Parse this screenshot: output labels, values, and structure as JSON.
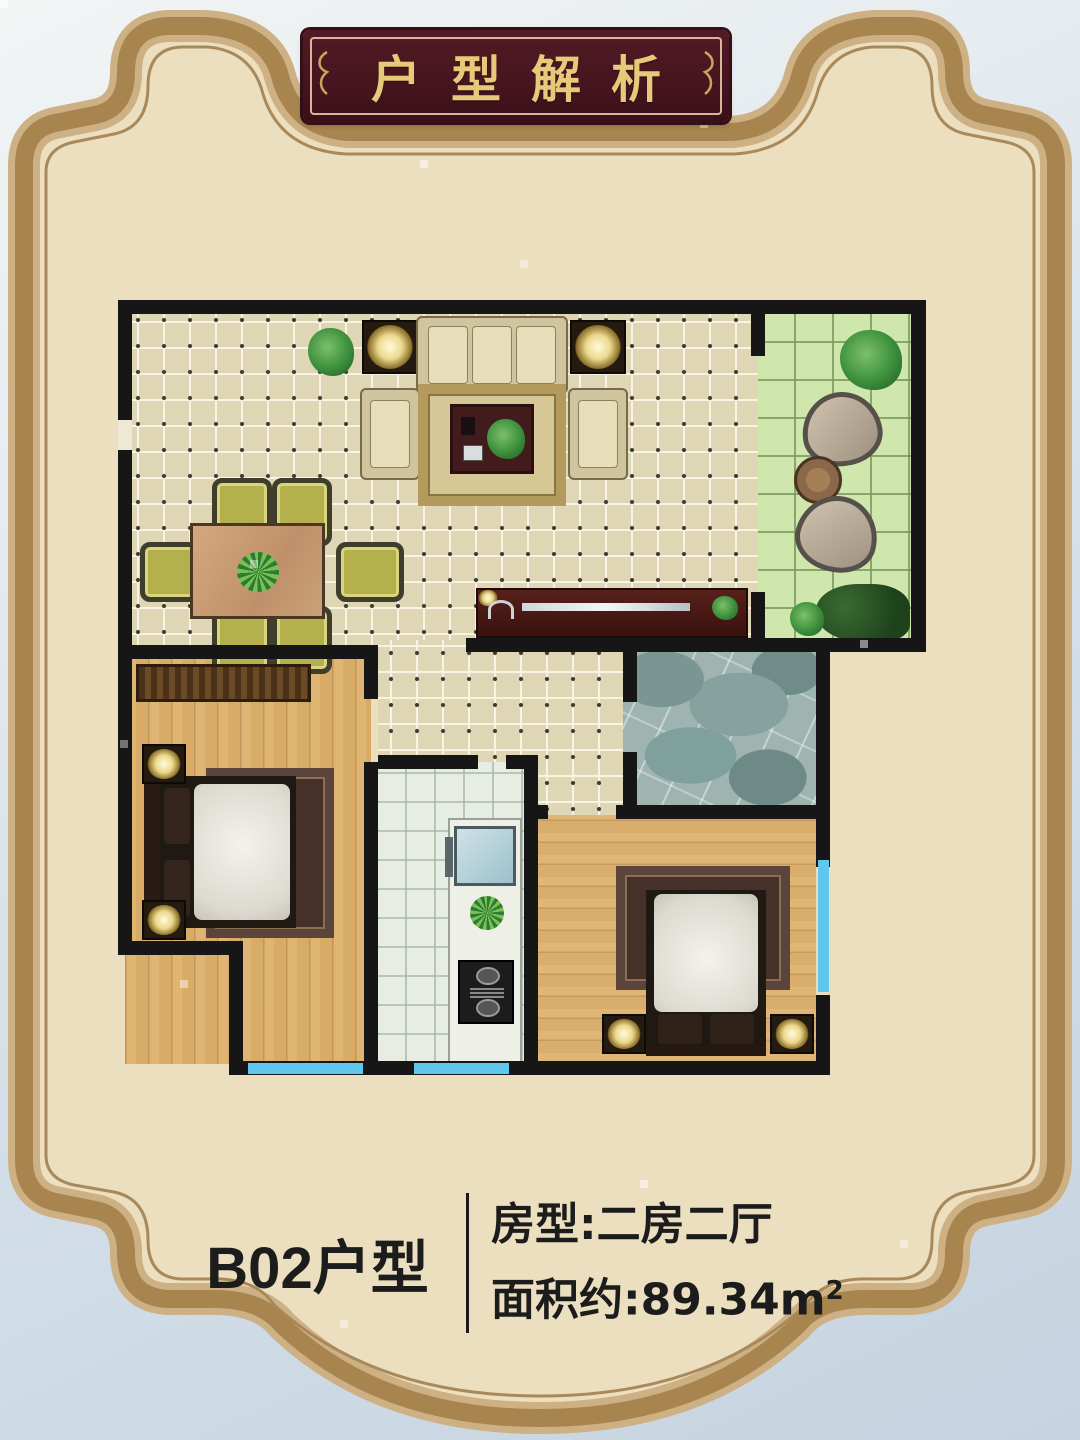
{
  "poster": {
    "title": "户型解析",
    "unit": {
      "label": "B02户型"
    },
    "specs": {
      "room_type": "房型:二房二厅",
      "area_label": "面积约:89.34m",
      "area_sup": "2"
    },
    "colors": {
      "poster_cream": "#ecdfc0",
      "frame_band_dark": "#a8854e",
      "frame_band_light": "#cdb184",
      "frame_thin_line": "#a9895a",
      "plaque_maroon": "#47151f",
      "title_gold": "#e6c979",
      "wall_black": "#161616",
      "window_blue": "#5fc6ee",
      "photo_background": "#d4dfe8"
    },
    "floorplan": {
      "rooms": [
        "living-dining-room",
        "balcony-garden",
        "hallway",
        "bathroom",
        "bedroom-left",
        "kitchen",
        "bedroom-right"
      ],
      "furniture": [
        "sofa-set",
        "coffee-table",
        "carpet",
        "tv-cabinet",
        "dining-table",
        "dining-chairs",
        "wardrobe",
        "double-bed-left",
        "double-bed-right",
        "nightstand-lamps",
        "kitchen-counter",
        "sink",
        "gas-stove",
        "garden-tree",
        "stone-chairs",
        "round-table",
        "shrubs",
        "potted-plants"
      ]
    }
  }
}
